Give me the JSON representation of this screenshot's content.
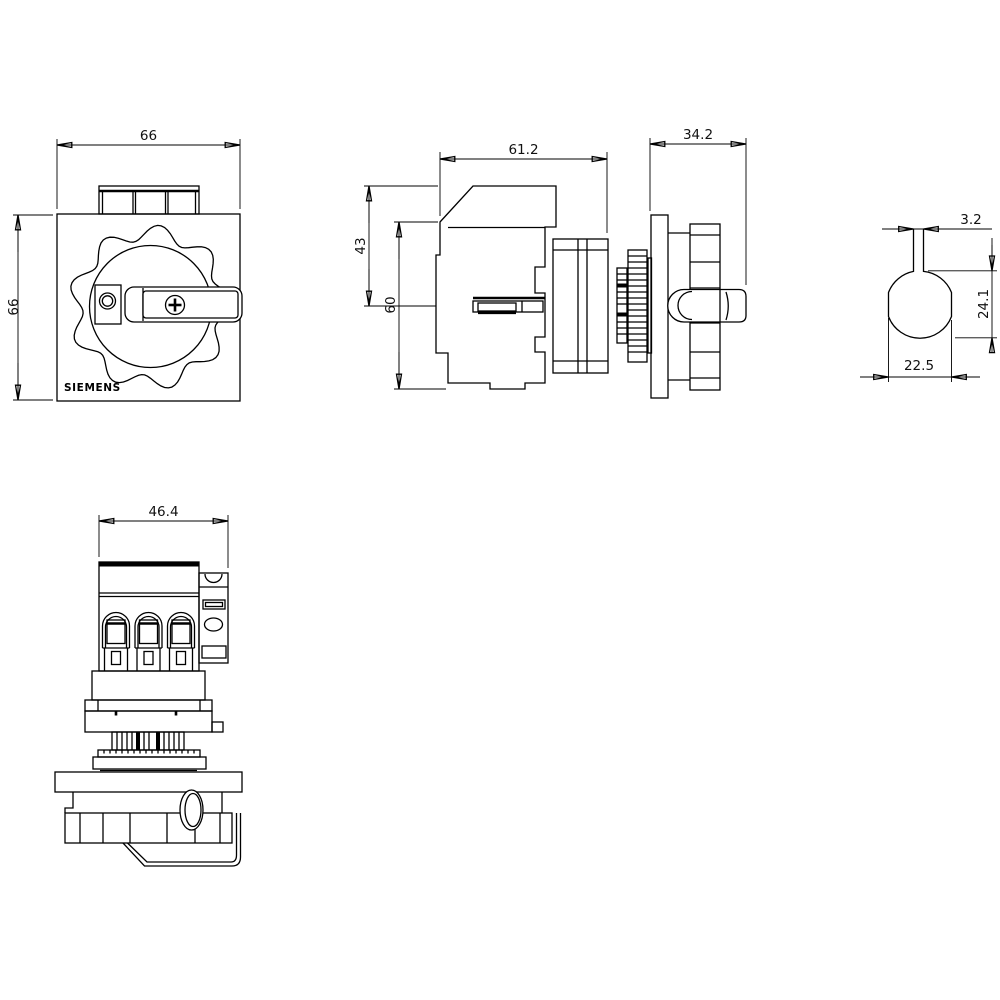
{
  "brand_label": "SIEMENS",
  "dimensions": {
    "front_width": "66",
    "front_height": "66",
    "side_body_width": "61.2",
    "side_handle_depth": "34.2",
    "side_upper_height": "43",
    "side_body_height": "60",
    "cutout_slot_width": "3.2",
    "cutout_height": "24.1",
    "cutout_width": "22.5",
    "top_view_width": "46.4"
  }
}
